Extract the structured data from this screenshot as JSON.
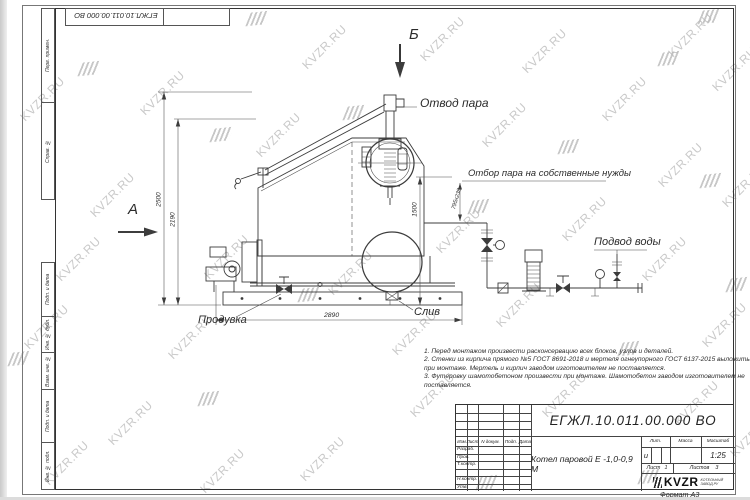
{
  "watermark": {
    "text": "KVZR.RU"
  },
  "stamp_top": {
    "doc_number": "ЕГЖЛ.10.011.00.000  ВО"
  },
  "frame_left": {
    "cells": [
      "Перв. примен.",
      "Справ. №",
      "Подп. и дата",
      "Инв. № дубл.",
      "Взам. инв. №",
      "Подп. и дата",
      "Инв. № подл."
    ]
  },
  "drawing": {
    "section_a": "А",
    "section_b": "Б",
    "labels": {
      "steam_outlet": "Отвод пара",
      "steam_takeoff": "Отбор пара на собственные нужды",
      "water_inlet": "Подвод воды",
      "blowdown": "Продувка",
      "drain": "Слив"
    },
    "dimensions": {
      "height_total": "2500",
      "height_casing": "2190",
      "height_takeoff": "1500",
      "takeoff_offset": "795х238",
      "length": "2890"
    }
  },
  "notes": {
    "lines": [
      "1. Перед монтажом произвести расконсервацию всех блоков, узлов и деталей.",
      "2. Стенки из кирпича прямого  №5 ГОСТ 8691-2018 и мертеля огнеупорного ГОСТ 6137-2015 выложить",
      "при монтаже. Мертель и кирпич заводом изготовителем не поставляется.",
      "3. Футеровку шамотобетоном произвести при монтаже. Шамотобетон заводом изготовителем не",
      "поставляется."
    ]
  },
  "title_block": {
    "doc_number": "ЕГЖЛ.10.011.00.000  ВО",
    "product_name": "Котел паровой Е -1,0-0,9 М",
    "header": {
      "izm": "Изм",
      "list": "Лист",
      "doc": "N докум.",
      "sign": "Подп.",
      "date": "Дата"
    },
    "rows": {
      "r1": "Разраб.",
      "r2": "Пров.",
      "r3": "Т.контр.",
      "r4": "Н.контр.",
      "r5": "Утв."
    },
    "lit_label": "Лит.",
    "mass_label": "Масса",
    "scale_label": "Масштаб",
    "lit_value": "и",
    "scale_value": "1:25",
    "sheet_label": "Лист",
    "sheet_value": "1",
    "sheets_label": "Листов",
    "sheets_value": "3",
    "logo_word": "KVZR",
    "logo_sub1": "КОТЕЛЬНЫЙ",
    "logo_sub2": "ЗАВОД.РУ",
    "format_label": "Формат А3"
  }
}
